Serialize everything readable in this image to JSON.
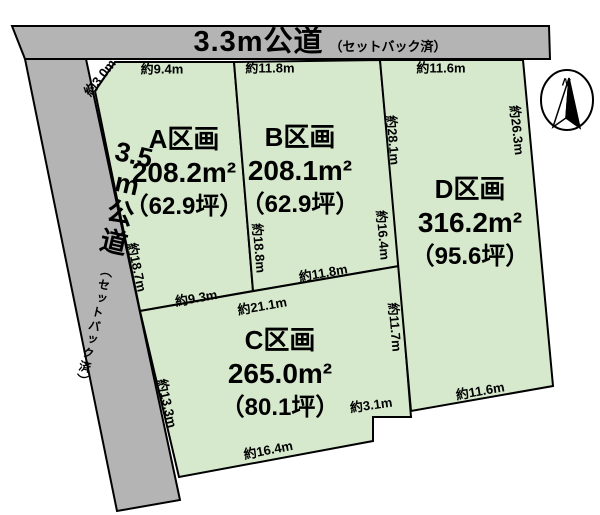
{
  "roads": {
    "top": {
      "name": "3.3m公道",
      "note": "（セットバック済）"
    },
    "left": {
      "lines": [
        "3.5",
        "m",
        "公",
        "道"
      ],
      "note": "（セットバック済）"
    }
  },
  "parcels": {
    "a": {
      "label": "A区画",
      "area": "208.2m²",
      "tsubo": "（62.9坪）"
    },
    "b": {
      "label": "B区画",
      "area": "208.1m²",
      "tsubo": "（62.9坪）"
    },
    "c": {
      "label": "C区画",
      "area": "265.0m²",
      "tsubo": "（80.1坪）"
    },
    "d": {
      "label": "D区画",
      "area": "316.2m²",
      "tsubo": "（95.6坪）"
    }
  },
  "dimensions": {
    "chamfer": "約3.0m",
    "a_top": "約9.4m",
    "b_top": "約11.8m",
    "d_top": "約11.6m",
    "d_right": "約26.3m",
    "d_left": "約28.1m",
    "b_right": "約16.4m",
    "c_right": "約11.7m",
    "ab_divider": "約18.8m",
    "a_left": "約18.7m",
    "a_bottom": "約9.3m",
    "c_top": "約21.1m",
    "b_bottom": "約11.8m",
    "c_left": "約13.3m",
    "c_bottom": "約16.4m",
    "c_step": "約3.1m",
    "d_bottom": "約11.6m"
  },
  "compass": {
    "north_label": "N"
  },
  "colors": {
    "road_fill": "#b4b4b4",
    "parcel_fill": "#d6e9cd",
    "outline": "#000000",
    "background": "#ffffff"
  }
}
